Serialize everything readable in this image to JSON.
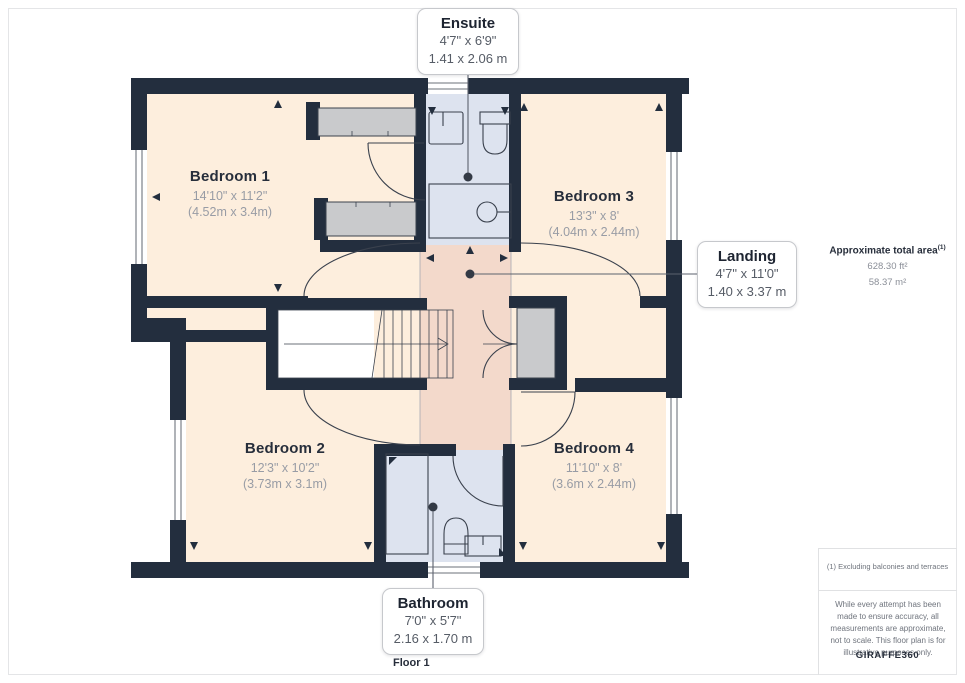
{
  "plan": {
    "floor_label": "Floor 1",
    "rooms": [
      {
        "name": "Bedroom 1",
        "dims_imperial": "14'10\" x 11'2\"",
        "dims_metric": "(4.52m x 3.4m)"
      },
      {
        "name": "Bedroom 2",
        "dims_imperial": "12'3\" x 10'2\"",
        "dims_metric": "(3.73m x 3.1m)"
      },
      {
        "name": "Bedroom 3",
        "dims_imperial": "13'3\" x 8'",
        "dims_metric": "(4.04m x 2.44m)"
      },
      {
        "name": "Bedroom 4",
        "dims_imperial": "11'10\" x 8'",
        "dims_metric": "(3.6m x 2.44m)"
      }
    ],
    "callouts": [
      {
        "name": "Ensuite",
        "dims_imperial": "4'7\" x 6'9\"",
        "dims_metric": "1.41 x 2.06 m"
      },
      {
        "name": "Landing",
        "dims_imperial": "4'7\" x 11'0\"",
        "dims_metric": "1.40 x 3.37 m"
      },
      {
        "name": "Bathroom",
        "dims_imperial": "7'0\" x 5'7\"",
        "dims_metric": "2.16 x 1.70 m"
      }
    ]
  },
  "sidebar": {
    "total_area_label": "Approximate total area",
    "total_area_superscript": "(1)",
    "area_ft": "628.30 ft²",
    "area_m": "58.37 m²",
    "footnote": "(1) Excluding balconies and terraces",
    "disclaimer": "While every attempt has been made to ensure accuracy, all measurements are approximate, not to scale. This floor plan is for illustrative purposes only.",
    "brand_name": "GIRAFFE",
    "brand_suffix": "360"
  },
  "colors": {
    "wall": "#232e3e",
    "floor": "#fdeedd",
    "wet_room": "#dde3ef",
    "landing": "#f3d9cb",
    "storage": "#c9cacc",
    "accent_text": "#272e3b",
    "muted_text": "#8b8f98"
  }
}
